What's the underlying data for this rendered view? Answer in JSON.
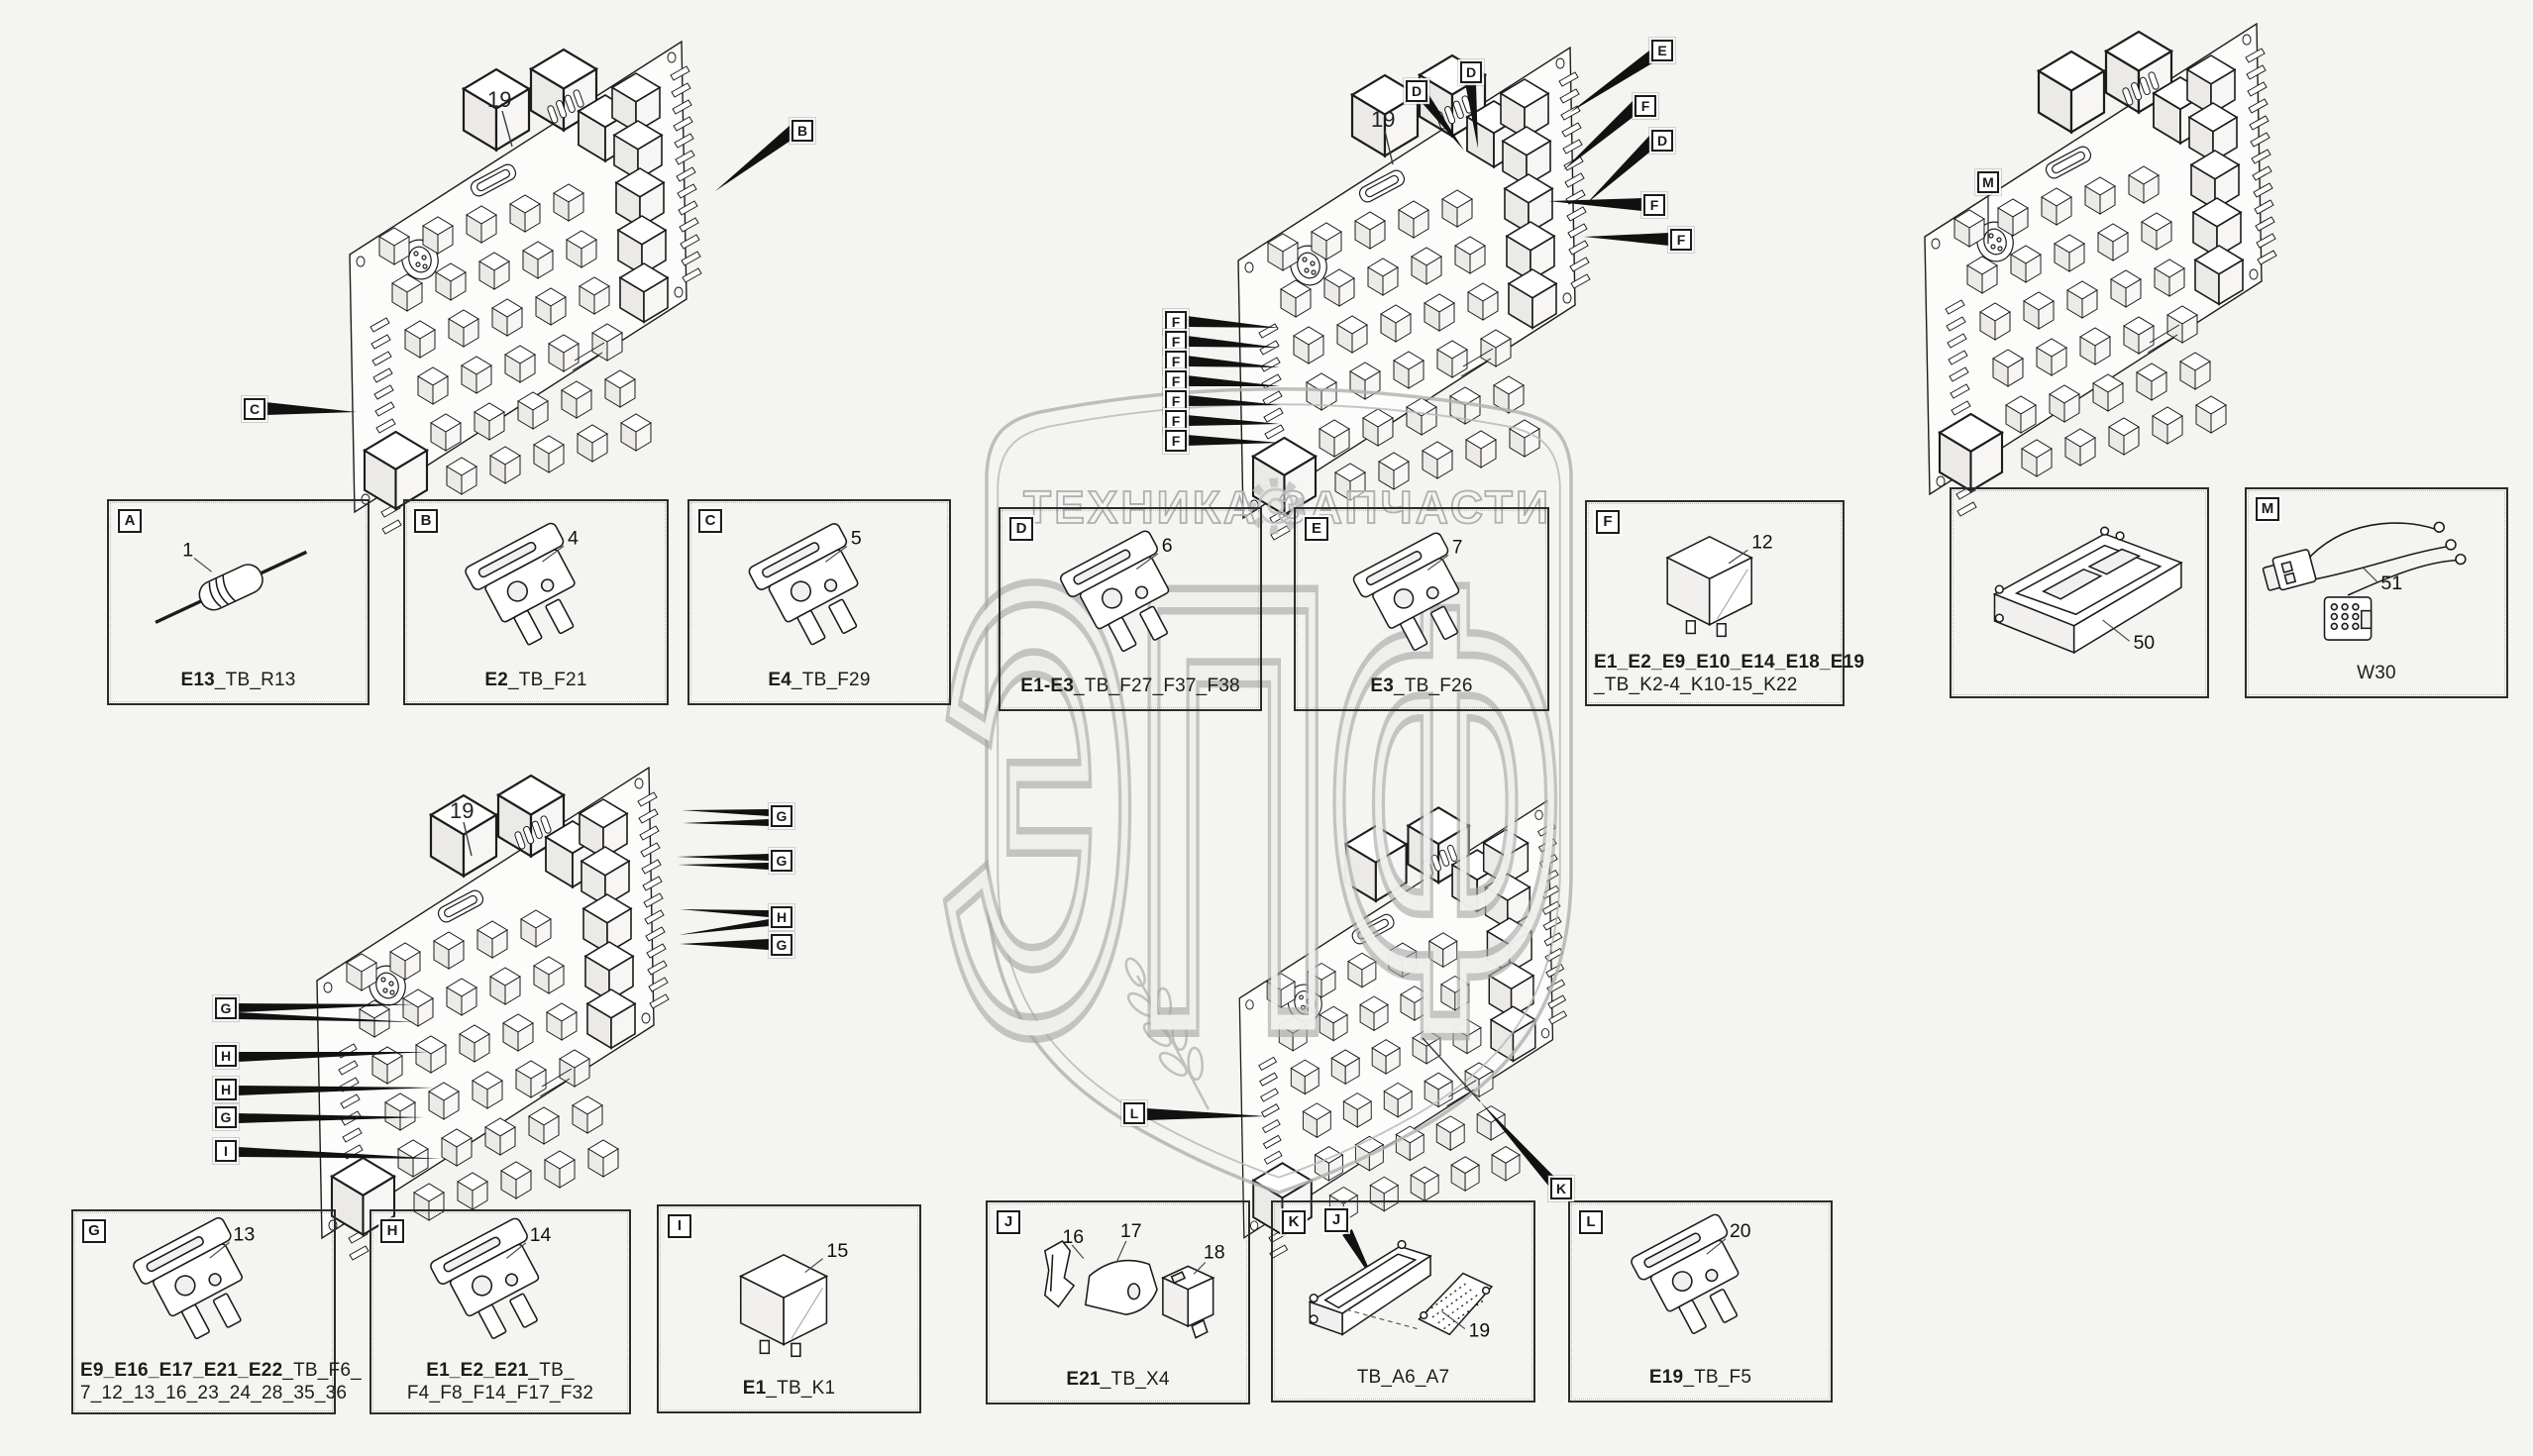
{
  "watermark": {
    "brand_left": "ТЕХНИКА",
    "brand_right": "ЗАПЧАСТИ",
    "big_letters": "ЭПФ"
  },
  "colors": {
    "background": "#f4f4f1",
    "line_art": "#1c1c1c",
    "watermark_gray": "#a9a9a9",
    "arrow_black": "#111111"
  },
  "boards": {
    "top_left": {
      "number": "19",
      "callout_b": "B",
      "callout_c": "C"
    },
    "top_middle": {
      "number": "19",
      "callout_d1": "D",
      "callout_d2": "D",
      "callout_e": "E",
      "callout_f1": "F",
      "callout_d3": "D",
      "callout_f2": "F",
      "callout_f3": "F",
      "f_column": [
        "F",
        "F",
        "F",
        "F",
        "F",
        "F",
        "F"
      ]
    },
    "top_right": {
      "callout_m": "M"
    },
    "bottom_left": {
      "number": "19",
      "right_callouts": [
        "G",
        "G",
        "H",
        "G"
      ],
      "left_callouts": [
        "G",
        "H",
        "H",
        "G",
        "I"
      ]
    },
    "bottom_middle": {
      "callout_l": "L",
      "callout_k": "K"
    }
  },
  "detail_boxes": {
    "a": {
      "letter": "A",
      "item": "1",
      "caption_bold": "E13",
      "caption_rest": "_TB_R13"
    },
    "b": {
      "letter": "B",
      "item": "4",
      "caption_bold": "E2",
      "caption_rest": "_TB_F21"
    },
    "c": {
      "letter": "C",
      "item": "5",
      "caption_bold": "E4",
      "caption_rest": "_TB_F29"
    },
    "d": {
      "letter": "D",
      "item": "6",
      "caption_bold": "E1-E3",
      "caption_rest": "_TB_F27_F37_F38"
    },
    "e": {
      "letter": "E",
      "item": "7",
      "caption_bold": "E3",
      "caption_rest": "_TB_F26"
    },
    "f": {
      "letter": "F",
      "item": "12",
      "caption_line1_bold": "E1_E2_E9_E10_E14_E18_E19",
      "caption_line2": "_TB_K2-4_K10-15_K22"
    },
    "module": {
      "item": "50"
    },
    "harness": {
      "letter": "M",
      "item": "51",
      "caption": "W30"
    },
    "g": {
      "letter": "G",
      "item": "13",
      "caption_line1_bold": "E9_E16_E17_E21_E22",
      "caption_line1_rest": "_TB_F6_",
      "caption_line2": "7_12_13_16_23_24_28_35_36"
    },
    "h": {
      "letter": "H",
      "item": "14",
      "caption_line1_bold": "E1_E2_E21",
      "caption_line1_rest": "_TB_",
      "caption_line2": "F4_F8_F14_F17_F32"
    },
    "i": {
      "letter": "I",
      "item": "15",
      "caption_bold": "E1",
      "caption_rest": "_TB_K1"
    },
    "j": {
      "letter": "J",
      "item_1": "16",
      "item_2": "17",
      "item_3": "18",
      "caption_bold": "E21",
      "caption_rest": "_TB_X4"
    },
    "k": {
      "letter": "K",
      "sub_label": "J",
      "item": "19",
      "caption": "TB_A6_A7"
    },
    "l": {
      "letter": "L",
      "item": "20",
      "caption_bold": "E19",
      "caption_rest": "_TB_F5"
    }
  }
}
